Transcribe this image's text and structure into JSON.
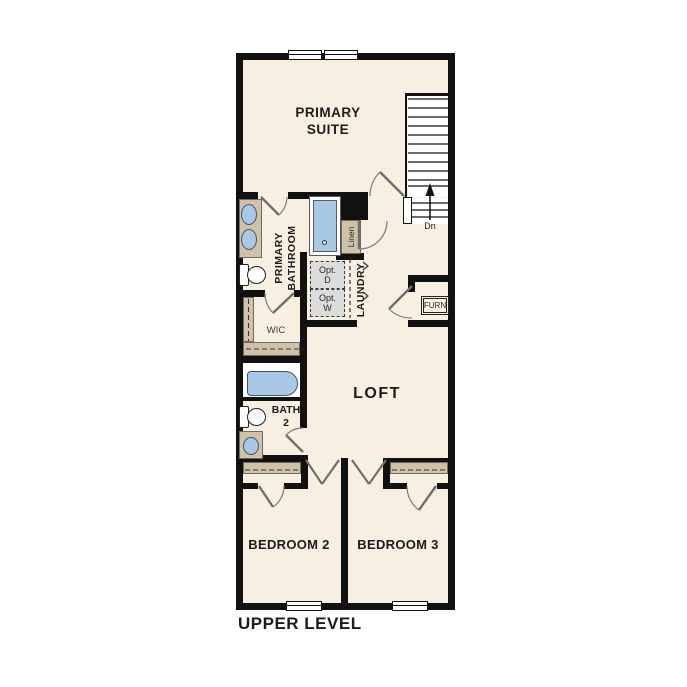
{
  "title": "UPPER LEVEL",
  "rooms": {
    "primary_suite": "PRIMARY\nSUITE",
    "primary_bathroom": "PRIMARY\nBATHROOM",
    "wic": "WIC",
    "laundry": "LAUNDRY",
    "loft": "LOFT",
    "bath_2": "BATH\n2",
    "bedroom_2": "BEDROOM 2",
    "bedroom_3": "BEDROOM 3"
  },
  "labels": {
    "linen": "Linen",
    "opt_dryer": "Opt.\nD",
    "opt_washer": "Opt.\nW",
    "furnace": "FURN",
    "stairs_down": "Dn"
  },
  "colors": {
    "wall": "#111111",
    "floor": "#f7efe2",
    "casework": "#cfc2a8",
    "fixture_blue": "#a9c8e6",
    "optional_fill": "#dcdcdc"
  }
}
